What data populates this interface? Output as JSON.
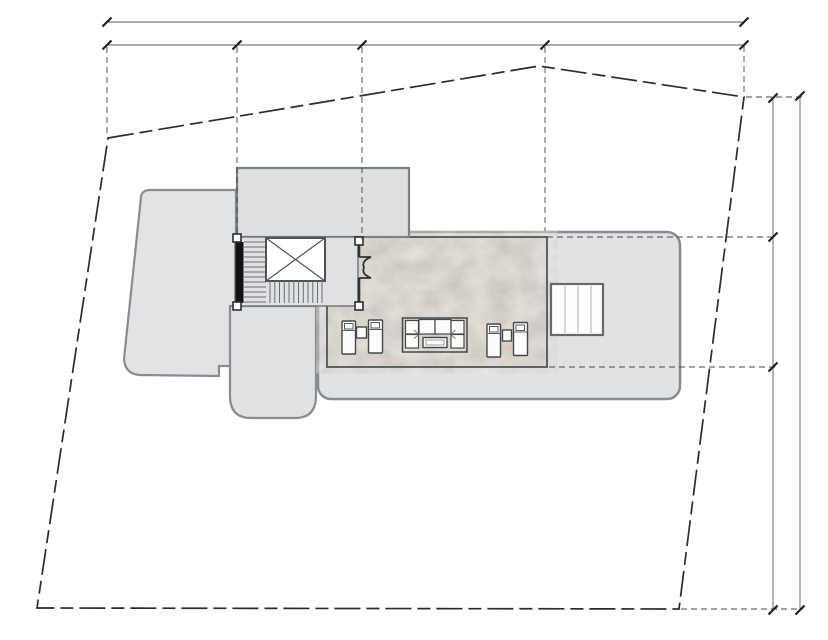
{
  "canvas": {
    "width": 828,
    "height": 640,
    "background": "#ffffff"
  },
  "palette": {
    "property_line": "#2c2c2c",
    "dimension_line": "#5e5e5e",
    "tick": "#1f1f1f",
    "extension_line": "#474747",
    "roof_fill": "#e0e2e4",
    "roof_left_fill": "#e2e3e5",
    "annex_fill": "#dfe1e2",
    "upper_block_fill": "#dddfe1",
    "roof_stroke": "#8a8c8f",
    "terrace_fill": "#d7d3c8",
    "terrace_stroke": "#5f6265",
    "stair_fill": "#e0e1e3",
    "stair_wall": "#121212",
    "furniture_fill": "#fcfcfb",
    "furniture_stroke": "#45484b",
    "skylight_fill": "#fdfdfd"
  },
  "drawing": {
    "elements": [
      {
        "tag": "path",
        "name": "roof-left",
        "attrs": {
          "d": "M150,190 L236,190 L236,366 L219,366 L219,376 L140,375 Q125,374 124,359 L141,197 Q142,190 150,190 Z",
          "fill": "#e2e3e5",
          "stroke": "#8a8c8f",
          "stroke-width": "2.2"
        }
      },
      {
        "tag": "path",
        "name": "roof-annex-wing",
        "attrs": {
          "d": "M230,306 L316,306 L316,396 Q316,418 295,418 L251,418 Q230,418 230,396 Z",
          "fill": "#dfe1e2",
          "stroke": "#8a8c8f",
          "stroke-width": "2.2"
        }
      },
      {
        "tag": "rect",
        "name": "roof-main",
        "attrs": {
          "x": "318",
          "y": "232",
          "width": "362",
          "height": "167",
          "rx": "13",
          "fill": "#e0e2e4",
          "stroke": "#898c8f",
          "stroke-width": "2.5"
        }
      },
      {
        "tag": "rect",
        "name": "terrace-deck",
        "attrs": {
          "x": "327",
          "y": "237",
          "width": "220",
          "height": "130",
          "fill": "#d7d3c8",
          "stroke": "none"
        }
      },
      {
        "tag": "rect",
        "name": "terrace-stone-texture",
        "attrs": {
          "x": "327",
          "y": "237",
          "width": "220",
          "height": "130",
          "fill": "#d7d3c8",
          "filter": "url(#stone)",
          "stroke": "none"
        }
      },
      {
        "tag": "rect",
        "name": "terrace-border",
        "attrs": {
          "x": "327",
          "y": "237",
          "width": "220",
          "height": "130",
          "fill": "none",
          "stroke": "#5f6265",
          "stroke-width": "2"
        }
      },
      {
        "tag": "rect",
        "name": "roof-upper-block",
        "attrs": {
          "x": "237",
          "y": "168",
          "width": "172",
          "height": "69",
          "fill": "#dddfe1",
          "stroke": "#7e8184",
          "stroke-width": "2.2"
        }
      },
      {
        "tag": "rect",
        "name": "stair-enclosure",
        "attrs": {
          "x": "235",
          "y": "237",
          "width": "123",
          "height": "69",
          "fill": "#e0e1e3",
          "stroke": "#6f7276",
          "stroke-width": "1.4"
        }
      },
      {
        "tag": "rect",
        "name": "stair-side-wall",
        "attrs": {
          "x": "235.5",
          "y": "242",
          "width": "8",
          "height": "61",
          "fill": "#121212",
          "stroke": "none"
        }
      },
      {
        "tag": "path",
        "name": "stair-upper-flight-treads",
        "attrs": {
          "d": "M244,242H266M244,247H266M244,252H266M244,257H266M244,262H266M244,267H266M244,272H266M244,277H266M244,282H266M244,287H266M244,292H266M244,297H266M244,302H266",
          "stroke": "#6a6d70",
          "stroke-width": "1",
          "fill": "none"
        }
      },
      {
        "tag": "rect",
        "name": "stair-void",
        "attrs": {
          "x": "266",
          "y": "238",
          "width": "59",
          "height": "43",
          "fill": "#ffffff",
          "stroke": "#505356",
          "stroke-width": "2"
        }
      },
      {
        "tag": "path",
        "name": "stair-void-x-mark",
        "attrs": {
          "d": "M266,238 L325,281 M325,238 L266,281",
          "stroke": "#505356",
          "stroke-width": "1.2",
          "fill": "none"
        }
      },
      {
        "tag": "path",
        "name": "stair-lower-flight-treads",
        "attrs": {
          "d": "M270,281V303M274.8,281V303M279.5,281V303M284.3,281V303M289,281V303M293.8,281V303M298.5,281V303M303.3,281V303M308,281V303M312.8,281V303M317.5,281V303M322,281V303",
          "stroke": "#6a6d70",
          "stroke-width": "1",
          "fill": "none"
        }
      },
      {
        "tag": "rect",
        "name": "column-post-stair-top",
        "attrs": {
          "x": "233",
          "y": "234",
          "width": "8",
          "height": "8",
          "fill": "#ffffff",
          "stroke": "#2e2e2e",
          "stroke-width": "1.6"
        }
      },
      {
        "tag": "rect",
        "name": "column-post-stair-bottom",
        "attrs": {
          "x": "233",
          "y": "302",
          "width": "8",
          "height": "8",
          "fill": "#ffffff",
          "stroke": "#2e2e2e",
          "stroke-width": "1.6"
        }
      },
      {
        "tag": "rect",
        "name": "column-post-door-top",
        "attrs": {
          "x": "355",
          "y": "237",
          "width": "8",
          "height": "8",
          "fill": "#ffffff",
          "stroke": "#2e2e2e",
          "stroke-width": "1.6"
        }
      },
      {
        "tag": "rect",
        "name": "column-post-door-bottom",
        "attrs": {
          "x": "355",
          "y": "302",
          "width": "8",
          "height": "8",
          "fill": "#ffffff",
          "stroke": "#2e2e2e",
          "stroke-width": "1.6"
        }
      },
      {
        "tag": "path",
        "name": "terrace-door-wall",
        "attrs": {
          "d": "M359,245 V257 M359,278 V302",
          "stroke": "#2f3235",
          "stroke-width": "2.6",
          "fill": "none"
        }
      },
      {
        "tag": "path",
        "name": "terrace-door-swing",
        "attrs": {
          "d": "M359,257 H371 Q361,261 364,267.5 Q361,274 371,278 H359",
          "stroke": "#2f3235",
          "stroke-width": "1.8",
          "fill": "none"
        }
      },
      {
        "tag": "rect",
        "name": "skylight",
        "attrs": {
          "x": "551",
          "y": "284",
          "width": "52",
          "height": "51",
          "fill": "#fdfdfd",
          "stroke": "#67696c",
          "stroke-width": "2.2"
        }
      },
      {
        "tag": "path",
        "name": "skylight-glazing-bars",
        "attrs": {
          "d": "M565,286 V333 M578,286 V333 M591,286 V333",
          "stroke": "#b9bbbd",
          "stroke-width": "1.2",
          "fill": "none"
        }
      },
      {
        "tag": "rect",
        "name": "lounger-1",
        "attrs": {
          "x": "342",
          "y": "321",
          "width": "13.5",
          "height": "33",
          "rx": "1",
          "fill": "#fcfcfb",
          "stroke": "#45484b",
          "stroke-width": "1.4"
        }
      },
      {
        "tag": "path",
        "name": "lounger-1-pillow",
        "attrs": {
          "d": "M344.5,323.5 h8.5 v5.5 h-8.5 Z M342,330.5 h13.5",
          "stroke": "#5a5d60",
          "stroke-width": "1",
          "fill": "#ffffff"
        }
      },
      {
        "tag": "rect",
        "name": "side-table-1",
        "attrs": {
          "x": "356.5",
          "y": "327",
          "width": "10",
          "height": "11",
          "fill": "#fcfcfb",
          "stroke": "#45484b",
          "stroke-width": "1.4"
        }
      },
      {
        "tag": "rect",
        "name": "lounger-2",
        "attrs": {
          "x": "368.5",
          "y": "320",
          "width": "14",
          "height": "33",
          "rx": "1",
          "fill": "#fcfcfb",
          "stroke": "#45484b",
          "stroke-width": "1.4"
        }
      },
      {
        "tag": "path",
        "name": "lounger-2-pillow",
        "attrs": {
          "d": "M371,322.5 h8.5 v5.5 h-8.5 Z M368.5,329.5 h14",
          "stroke": "#5a5d60",
          "stroke-width": "1",
          "fill": "#ffffff"
        }
      },
      {
        "tag": "rect",
        "name": "sofa-outline",
        "attrs": {
          "x": "402.5",
          "y": "318",
          "width": "64.5",
          "height": "34",
          "fill": "none",
          "stroke": "#45484b",
          "stroke-width": "1.5"
        }
      },
      {
        "tag": "rect",
        "name": "sofa-module-corner-tl",
        "attrs": {
          "x": "405.5",
          "y": "320.5",
          "width": "13",
          "height": "13.5",
          "fill": "#fcfcfb",
          "stroke": "#45484b",
          "stroke-width": "1.2"
        }
      },
      {
        "tag": "rect",
        "name": "sofa-module-seat-1",
        "attrs": {
          "x": "419",
          "y": "319.5",
          "width": "16",
          "height": "14.5",
          "fill": "#fcfcfb",
          "stroke": "#45484b",
          "stroke-width": "1.2"
        }
      },
      {
        "tag": "rect",
        "name": "sofa-module-seat-2",
        "attrs": {
          "x": "435",
          "y": "319.5",
          "width": "16",
          "height": "14.5",
          "fill": "#fcfcfb",
          "stroke": "#45484b",
          "stroke-width": "1.2"
        }
      },
      {
        "tag": "rect",
        "name": "sofa-module-corner-tr",
        "attrs": {
          "x": "451",
          "y": "320.5",
          "width": "13",
          "height": "13.5",
          "fill": "#fcfcfb",
          "stroke": "#45484b",
          "stroke-width": "1.2"
        }
      },
      {
        "tag": "rect",
        "name": "sofa-module-corner-bl",
        "attrs": {
          "x": "405.5",
          "y": "334.5",
          "width": "13",
          "height": "13.5",
          "fill": "#fcfcfb",
          "stroke": "#45484b",
          "stroke-width": "1.2"
        }
      },
      {
        "tag": "rect",
        "name": "sofa-module-corner-br",
        "attrs": {
          "x": "451",
          "y": "334.5",
          "width": "13",
          "height": "13.5",
          "fill": "#fcfcfb",
          "stroke": "#45484b",
          "stroke-width": "1.2"
        }
      },
      {
        "tag": "path",
        "name": "sofa-cushion-creases",
        "attrs": {
          "d": "M414,330 L418.5,334 M455.5,330 L451,334 M414,338.5 L418.5,334.8 M455.5,338.5 L451,334.8",
          "stroke": "#77797c",
          "stroke-width": "0.9",
          "fill": "none"
        }
      },
      {
        "tag": "rect",
        "name": "coffee-table",
        "attrs": {
          "x": "423",
          "y": "337.5",
          "width": "24",
          "height": "10",
          "fill": "#fbfbfa",
          "stroke": "#45484b",
          "stroke-width": "1.4"
        }
      },
      {
        "tag": "rect",
        "name": "coffee-table-inner",
        "attrs": {
          "x": "426",
          "y": "340",
          "width": "18",
          "height": "5",
          "fill": "none",
          "stroke": "#8a8c8e",
          "stroke-width": "0.8"
        }
      },
      {
        "tag": "rect",
        "name": "lounger-3",
        "attrs": {
          "x": "487",
          "y": "324",
          "width": "13.5",
          "height": "33",
          "rx": "1",
          "fill": "#fcfcfb",
          "stroke": "#45484b",
          "stroke-width": "1.4"
        }
      },
      {
        "tag": "path",
        "name": "lounger-3-pillow",
        "attrs": {
          "d": "M489.5,326.5 h8.5 v5.5 h-8.5 Z M487,333.5 h13.5",
          "stroke": "#5a5d60",
          "stroke-width": "1",
          "fill": "#ffffff"
        }
      },
      {
        "tag": "rect",
        "name": "side-table-2",
        "attrs": {
          "x": "502.5",
          "y": "330",
          "width": "9",
          "height": "11",
          "fill": "#fcfcfb",
          "stroke": "#45484b",
          "stroke-width": "1.4"
        }
      },
      {
        "tag": "rect",
        "name": "lounger-4",
        "attrs": {
          "x": "513.5",
          "y": "322.5",
          "width": "14",
          "height": "33",
          "rx": "1",
          "fill": "#fcfcfb",
          "stroke": "#45484b",
          "stroke-width": "1.4"
        }
      },
      {
        "tag": "path",
        "name": "lounger-4-pillow",
        "attrs": {
          "d": "M516,325 h8.5 v5.5 h-8.5 Z M513.5,332 h14",
          "stroke": "#5a5d60",
          "stroke-width": "1",
          "fill": "#ffffff"
        }
      },
      {
        "tag": "path",
        "name": "extension-line-terrace-top",
        "attrs": {
          "d": "M547,237 H775",
          "stroke": "#474747",
          "stroke-width": "0.9",
          "stroke-dasharray": "6 4",
          "fill": "none"
        }
      },
      {
        "tag": "path",
        "name": "extension-line-terrace-bottom",
        "attrs": {
          "d": "M549,367 H775",
          "stroke": "#474747",
          "stroke-width": "0.9",
          "stroke-dasharray": "6 4",
          "fill": "none"
        }
      },
      {
        "tag": "path",
        "name": "extension-line-site-corner-ne",
        "attrs": {
          "d": "M746,97 H803",
          "stroke": "#474747",
          "stroke-width": "0.9",
          "stroke-dasharray": "6 4",
          "fill": "none"
        }
      },
      {
        "tag": "path",
        "name": "extension-line-site-corner-se",
        "attrs": {
          "d": "M681,609 H803",
          "stroke": "#474747",
          "stroke-width": "0.9",
          "stroke-dasharray": "6 4",
          "fill": "none"
        }
      },
      {
        "tag": "path",
        "name": "extension-line-site-corner-nw",
        "attrs": {
          "d": "M107,47 V137",
          "stroke": "#474747",
          "stroke-width": "0.9",
          "stroke-dasharray": "6 4",
          "fill": "none"
        }
      },
      {
        "tag": "path",
        "name": "extension-line-stair-axis",
        "attrs": {
          "d": "M237,47 V236",
          "stroke": "#474747",
          "stroke-width": "0.9",
          "stroke-dasharray": "6 4",
          "fill": "none"
        }
      },
      {
        "tag": "path",
        "name": "extension-line-door-axis",
        "attrs": {
          "d": "M362,47 V239",
          "stroke": "#474747",
          "stroke-width": "0.9",
          "stroke-dasharray": "6 4",
          "fill": "none"
        }
      },
      {
        "tag": "path",
        "name": "extension-line-roof-axis",
        "attrs": {
          "d": "M545,47 V231",
          "stroke": "#474747",
          "stroke-width": "0.9",
          "stroke-dasharray": "6 4",
          "fill": "none"
        }
      },
      {
        "tag": "path",
        "name": "extension-line-site-corner-ne-vertical",
        "attrs": {
          "d": "M744,46 V95",
          "stroke": "#474747",
          "stroke-width": "0.9",
          "stroke-dasharray": "6 4",
          "fill": "none"
        }
      },
      {
        "tag": "polygon",
        "name": "site-boundary",
        "attrs": {
          "points": "108,138 539,66 744,97 679,609 37,608",
          "fill": "none",
          "stroke": "#2c2c2c",
          "stroke-width": "1.7",
          "stroke-dasharray": "26 6 13 6"
        }
      },
      {
        "tag": "path",
        "name": "dimension-line-top-overall",
        "attrs": {
          "d": "M107,22 H744",
          "stroke": "#5e5e5e",
          "stroke-width": "0.9",
          "fill": "none"
        }
      },
      {
        "tag": "path",
        "name": "dimension-line-top-segments",
        "attrs": {
          "d": "M107,45 H744",
          "stroke": "#5e5e5e",
          "stroke-width": "0.9",
          "fill": "none"
        }
      },
      {
        "tag": "path",
        "name": "dimension-line-right-segments",
        "attrs": {
          "d": "M773,98 V610",
          "stroke": "#5e5e5e",
          "stroke-width": "0.9",
          "fill": "none"
        }
      },
      {
        "tag": "path",
        "name": "dimension-line-right-overall",
        "attrs": {
          "d": "M800,96 V610",
          "stroke": "#5e5e5e",
          "stroke-width": "0.9",
          "fill": "none"
        }
      },
      {
        "tag": "path",
        "name": "dimension-ticks-top",
        "attrs": {
          "d": "M102.5,26.5 L111.5,17.5 M739.5,26.5 L748.5,17.5 M102.5,49.5 L111.5,40.5 M232.5,49.5 L241.5,40.5 M357.5,49.5 L366.5,40.5 M540.5,49.5 L549.5,40.5 M739.5,49.5 L748.5,40.5",
          "stroke": "#1f1f1f",
          "stroke-width": "2.2",
          "fill": "none"
        }
      },
      {
        "tag": "path",
        "name": "dimension-ticks-right",
        "attrs": {
          "d": "M768.5,102.5 L777.5,93.5 M768.5,241.5 L777.5,232.5 M768.5,371.5 L777.5,362.5 M768.5,614.5 L777.5,605.5 M795.5,100.5 L804.5,91.5 M795.5,614.5 L804.5,605.5",
          "stroke": "#1f1f1f",
          "stroke-width": "2.2",
          "fill": "none"
        }
      }
    ]
  }
}
